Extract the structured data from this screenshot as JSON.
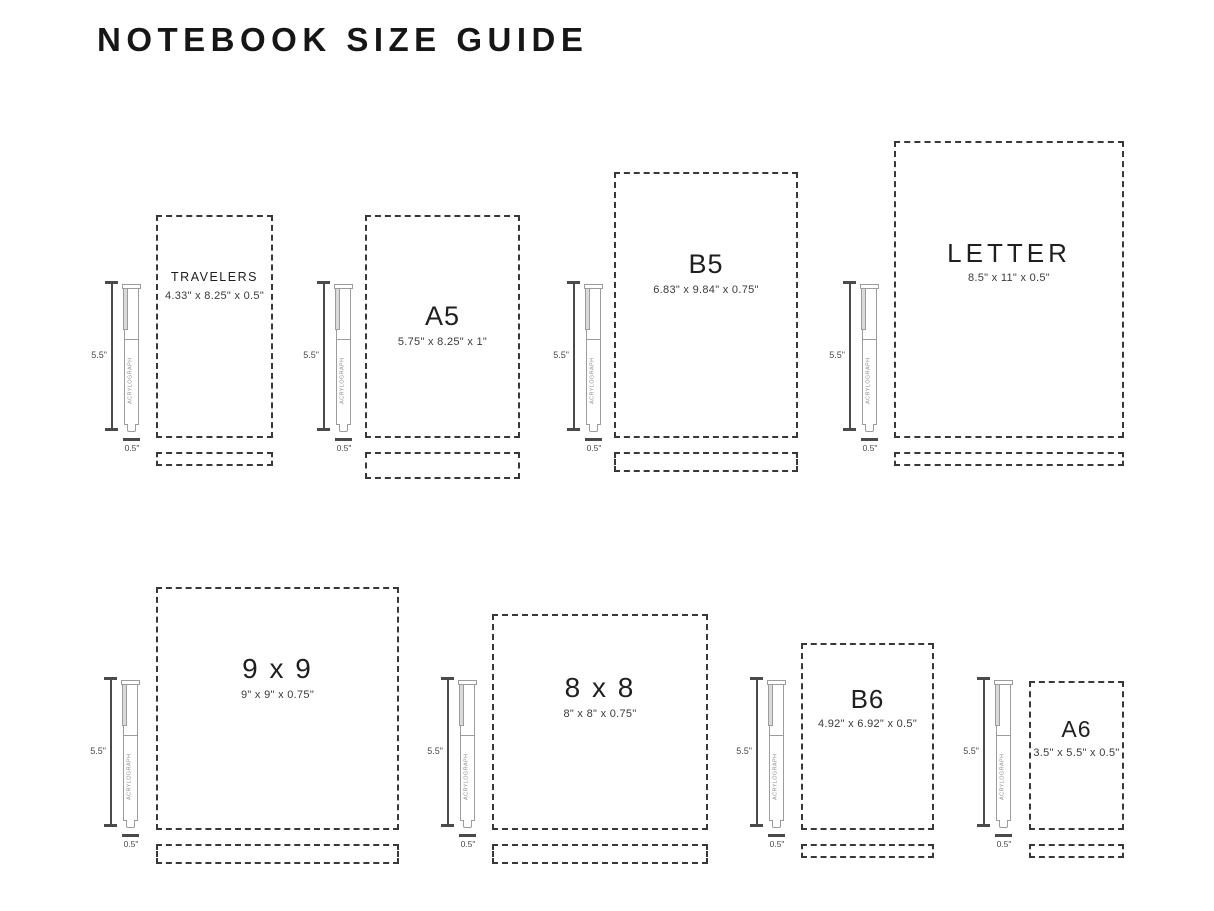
{
  "title": "NOTEBOOK SIZE GUIDE",
  "pen": {
    "brand": "ACRYLOGRAPH",
    "length_label": "5.5\"",
    "width_label": "0.5\""
  },
  "notebooks": [
    {
      "name": "TRAVELERS",
      "dimensions": "4.33\" x 8.25\" x 0.5\"",
      "width_in": 4.33,
      "height_in": 8.25,
      "depth_in": 0.5
    },
    {
      "name": "A5",
      "dimensions": "5.75\" x 8.25\" x 1\"",
      "width_in": 5.75,
      "height_in": 8.25,
      "depth_in": 1
    },
    {
      "name": "B5",
      "dimensions": "6.83\" x 9.84\" x 0.75\"",
      "width_in": 6.83,
      "height_in": 9.84,
      "depth_in": 0.75
    },
    {
      "name": "LETTER",
      "dimensions": "8.5\" x 11\" x 0.5\"",
      "width_in": 8.5,
      "height_in": 11,
      "depth_in": 0.5
    },
    {
      "name": "9 x 9",
      "dimensions": "9\" x 9\" x 0.75\"",
      "width_in": 9,
      "height_in": 9,
      "depth_in": 0.75
    },
    {
      "name": "8 x 8",
      "dimensions": "8\" x 8\" x 0.75\"",
      "width_in": 8,
      "height_in": 8,
      "depth_in": 0.75
    },
    {
      "name": "B6",
      "dimensions": "4.92\" x 6.92\" x 0.5\"",
      "width_in": 4.92,
      "height_in": 6.92,
      "depth_in": 0.5
    },
    {
      "name": "A6",
      "dimensions": "3.5\" x 5.5\" x 0.5\"",
      "width_in": 3.5,
      "height_in": 5.5,
      "depth_in": 0.5
    }
  ],
  "colors": {
    "ink": "#1f1f1f",
    "dash": "#383838",
    "pen_outline": "#9c9c9c",
    "measure": "#4a4a4a",
    "background": "#ffffff"
  },
  "scale_px_per_inch": 27
}
